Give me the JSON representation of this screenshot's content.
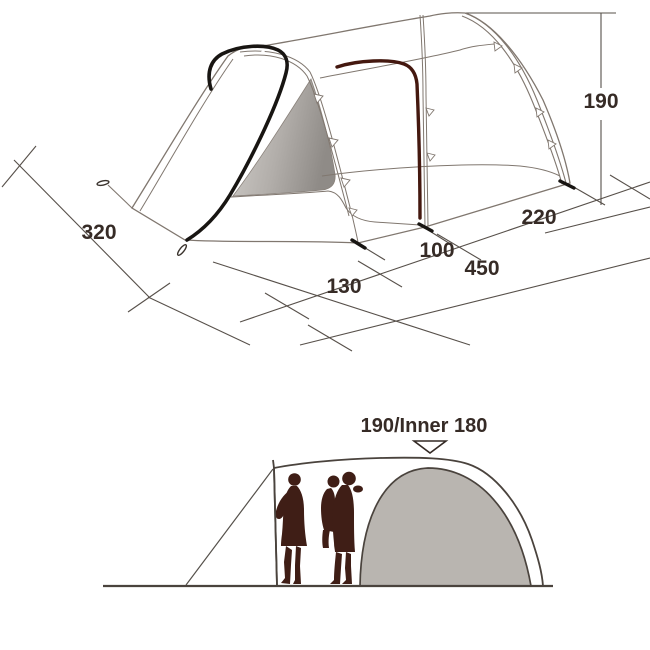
{
  "top_view": {
    "title": "tent-isometric-dimension-diagram",
    "labels": {
      "front_width": "320",
      "porch_depth": "130",
      "mid_section": "100",
      "inner_length": "220",
      "total_length": "450",
      "height": "190"
    }
  },
  "side_view": {
    "title": "tent-side-profile-with-people",
    "height_label": "190/Inner 180"
  },
  "colors": {
    "background": "#ffffff",
    "tent_outline": "#80776f",
    "dimension_line": "#57504a",
    "label_text": "#362b26",
    "door_pole_black": "#181512",
    "inner_pole_maroon": "#44180f",
    "people_silhouette": "#3f1e16",
    "inner_dome_gray": "#b9b5b0",
    "profile_line": "#4a433d",
    "window_gradient_light": "#ccc9c5",
    "window_gradient_dark": "#8f8b87"
  }
}
